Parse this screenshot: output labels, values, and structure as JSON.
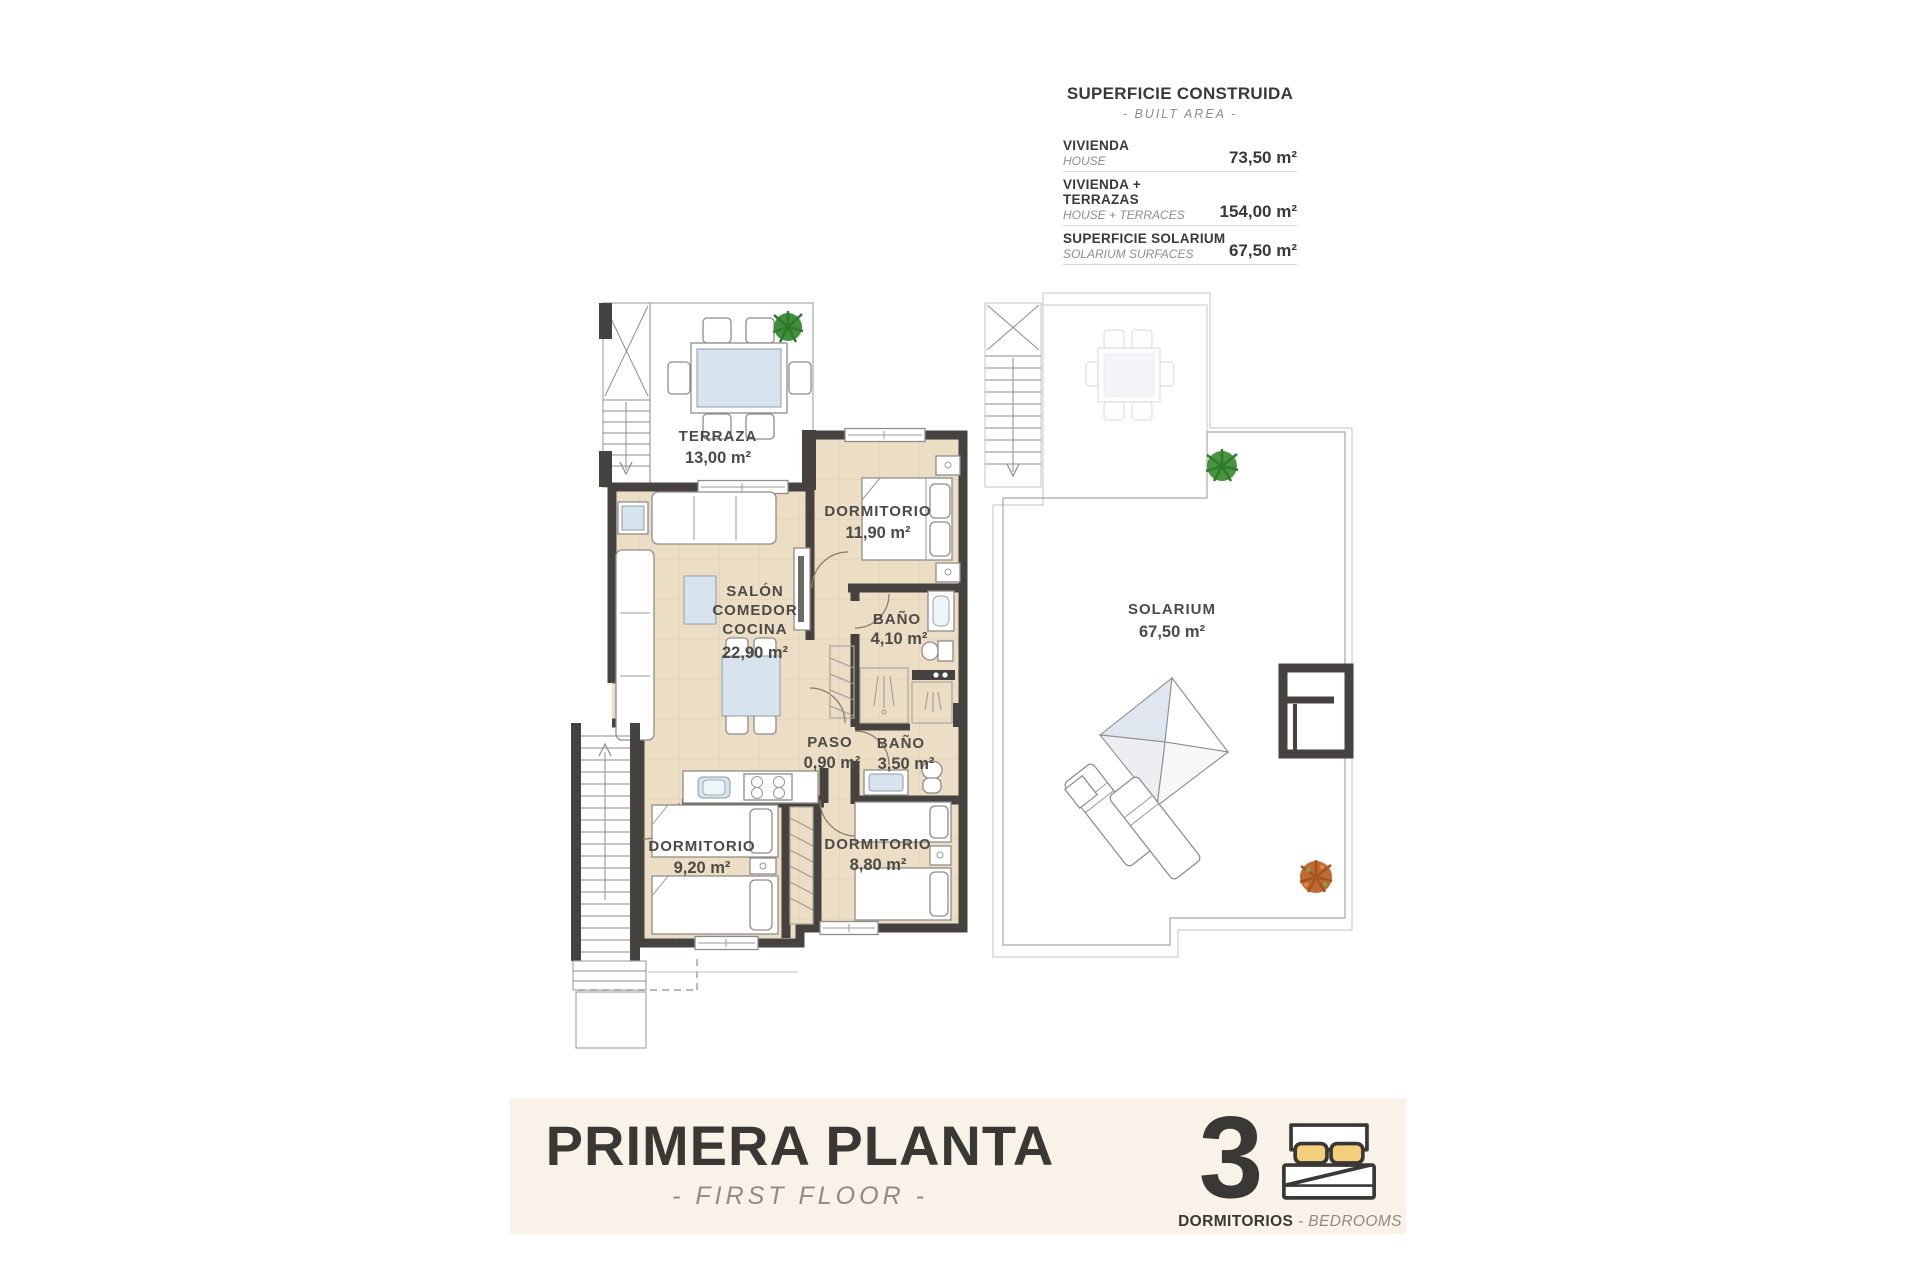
{
  "legend": {
    "title": "SUPERFICIE CONSTRUIDA",
    "subtitle": "- BUILT AREA -",
    "rows": [
      {
        "label_es": "VIVIENDA",
        "label_en": "HOUSE",
        "value": "73,50 m²"
      },
      {
        "label_es": "VIVIENDA + TERRAZAS",
        "label_en": "HOUSE + TERRACES",
        "value": "154,00 m²"
      },
      {
        "label_es": "SUPERFICIE SOLARIUM",
        "label_en": "SOLARIUM SURFACES",
        "value": "67,50 m²"
      }
    ]
  },
  "plan": {
    "rooms": {
      "terraza": {
        "name": "TERRAZA",
        "area": "13,00 m²"
      },
      "dorm1": {
        "name": "DORMITORIO",
        "area": "11,90 m²"
      },
      "salon": {
        "l1": "SALÓN",
        "l2": "COMEDOR",
        "l3": "COCINA",
        "area": "22,90 m²"
      },
      "bano1": {
        "name": "BAÑO",
        "area": "4,10 m²"
      },
      "paso": {
        "name": "PASO",
        "area": "0,90 m²"
      },
      "bano2": {
        "name": "BAÑO",
        "area": "3,50 m²"
      },
      "dorm2": {
        "name": "DORMITORIO",
        "area": "9,20 m²"
      },
      "dorm3": {
        "name": "DORMITORIO",
        "area": "8,80 m²"
      },
      "solarium": {
        "name": "SOLARIUM",
        "area": "67,50 m²"
      }
    }
  },
  "footer": {
    "title": "PRIMERA PLANTA",
    "subtitle": "- FIRST FLOOR -",
    "bedrooms_count": "3",
    "bedrooms_label_es": "DORMITORIOS",
    "bedrooms_label_en": "- BEDROOMS"
  },
  "colors": {
    "wall": "#454240",
    "floor_beige": "#ecddc5",
    "terrace_tile": "#dad6ce",
    "solarium_tile": "#e8e0da",
    "pillow_accent": "#f3cf7d",
    "banner_bg": "#f8f2e8",
    "text_dark": "#3b3936",
    "text_gray": "#8f8c88"
  }
}
